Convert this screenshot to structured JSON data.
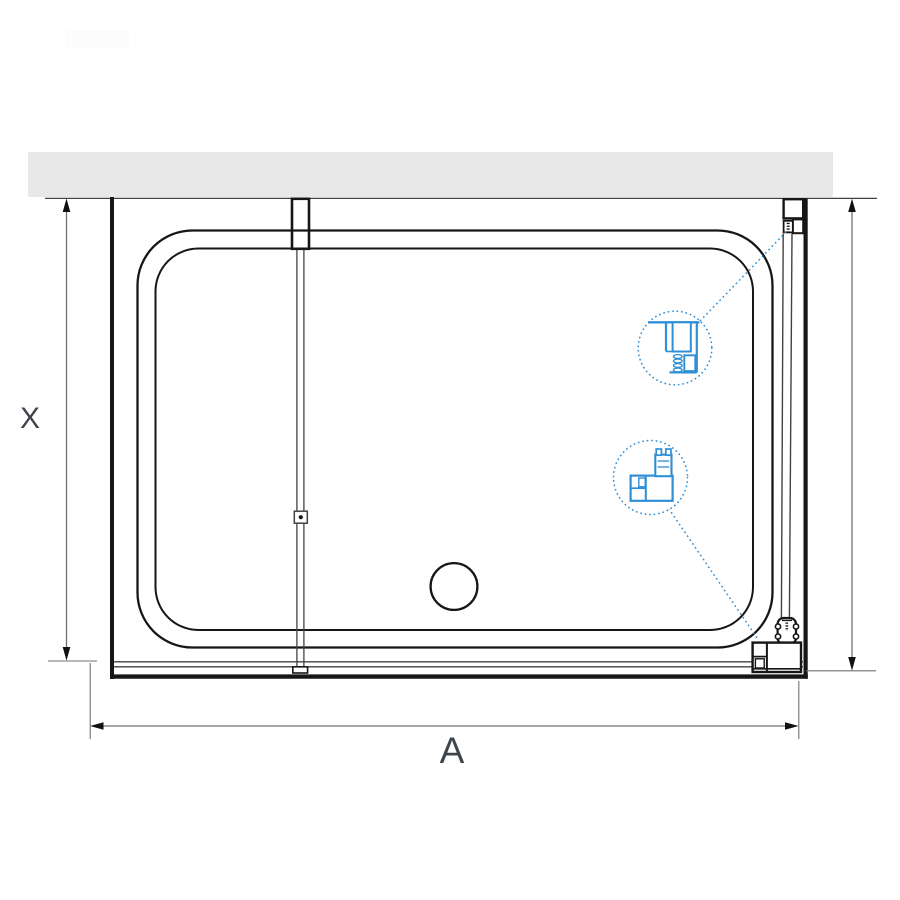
{
  "drawing": {
    "type": "shower-enclosure-top-view",
    "labels": {
      "dimension_x": "X",
      "dimension_a": "A"
    },
    "details": {
      "top_callout": "glass-to-wall-profile-detail",
      "bottom_callout": "glass-to-tray-bracket-detail"
    },
    "colors": {
      "wall_fill": "#e8e8e8",
      "line_strong": "#161616",
      "line_medium": "#424242",
      "dimension": "#707070",
      "arrow": "#111111",
      "accent_blue": "#2e8fd6",
      "label_text": "#3f454c",
      "watermark": "#fcfcfc"
    }
  }
}
